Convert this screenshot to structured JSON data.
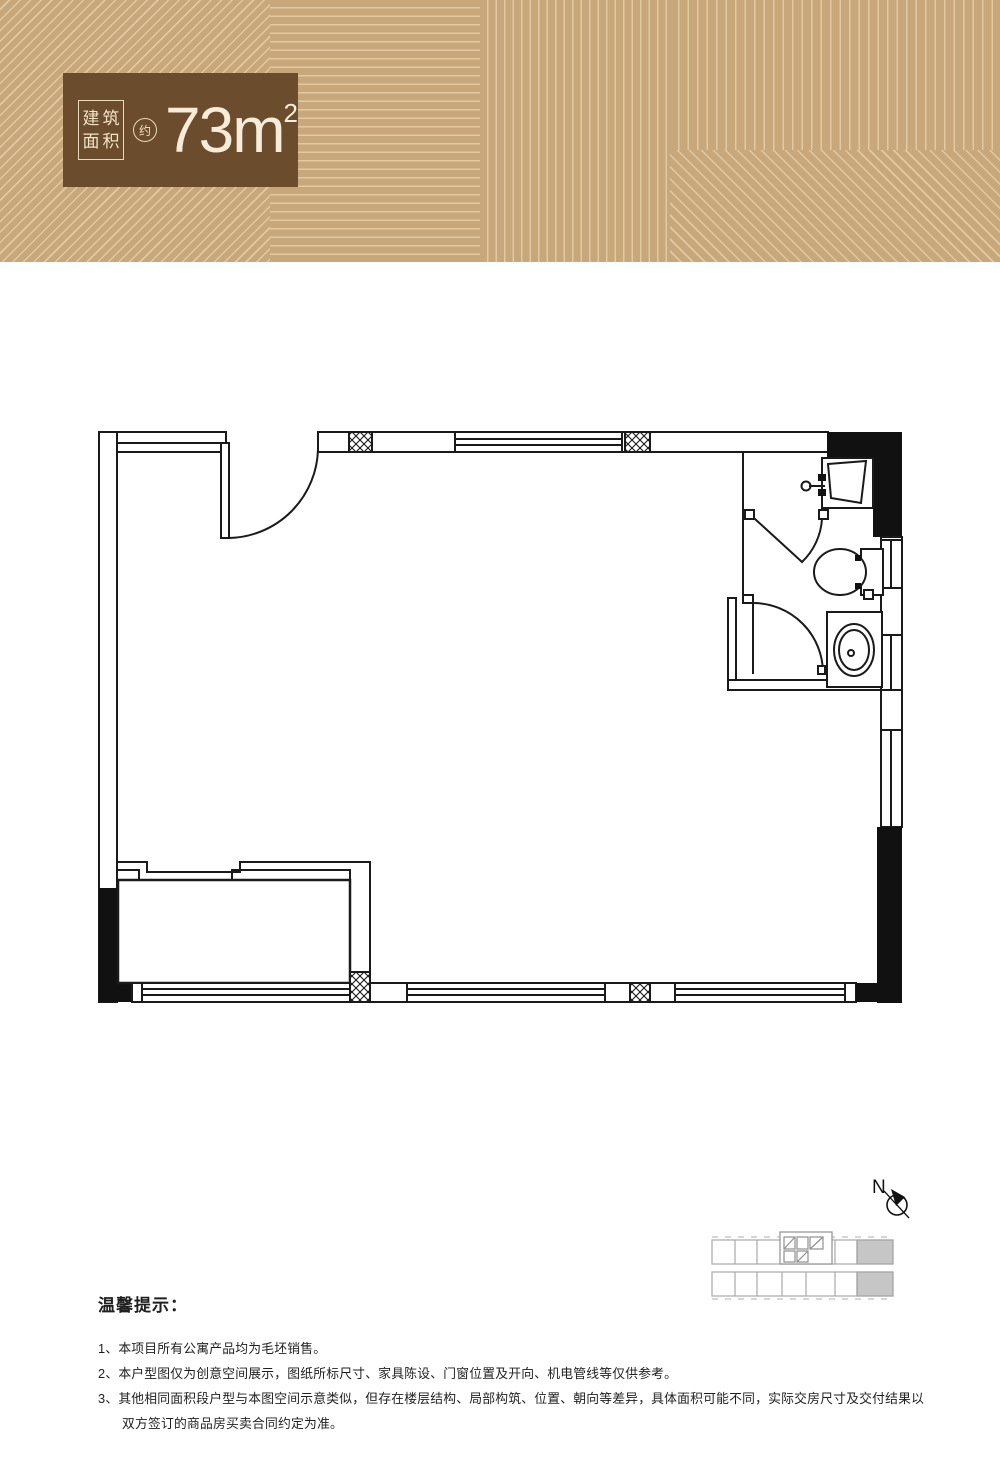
{
  "header": {
    "area_label_line1": "建筑",
    "area_label_line2": "面积",
    "approx_label": "约",
    "area_value": "73",
    "area_unit": "m",
    "area_exponent": "2",
    "colors": {
      "banner_bg": "#c8a77b",
      "badge_bg": "#6b4c2c",
      "badge_text": "#f7ecd9"
    }
  },
  "floor_plan": {
    "kind": "apartment-unit-plan",
    "line_color": "#1a1a1a",
    "features": [
      "entry-door",
      "main-open-space",
      "bathroom",
      "shower-area",
      "toilet",
      "washbasin",
      "lower-left-recess",
      "windows",
      "structural-columns",
      "solid-wall-fills"
    ]
  },
  "compass": {
    "north_label": "N"
  },
  "key_plan": {
    "highlighted_units": 2,
    "highlight_color": "#c6c6c6",
    "outline_color": "#a8a8a8"
  },
  "notes": {
    "title": "温馨提示：",
    "items": [
      "1、本项目所有公寓产品均为毛坯销售。",
      "2、本户型图仅为创意空间展示，图纸所标尺寸、家具陈设、门窗位置及开向、机电管线等仅供参考。",
      "3、其他相同面积段户型与本图空间示意类似，但存在楼层结构、局部构筑、位置、朝向等差异，具体面积可能不同，实际交房尺寸及交付结果以双方签订的商品房买卖合同约定为准。"
    ]
  }
}
